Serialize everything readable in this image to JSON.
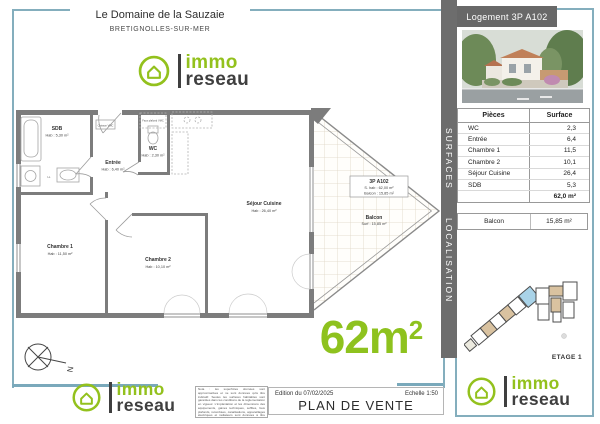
{
  "header": {
    "title": "Le Domaine de la Sauzaie",
    "city": "BRETIGNOLLES-SUR-MER"
  },
  "logo": {
    "line1": "immo",
    "line2": "reseau"
  },
  "right_panel": {
    "header": "Logement 3P A102",
    "sidebar": {
      "surfaces": "SURFACES",
      "localisation": "LOCALISATION"
    }
  },
  "surfaces": {
    "headers": {
      "pieces": "Pièces",
      "surface": "Surface"
    },
    "rows": [
      {
        "label": "WC",
        "value": "2,3"
      },
      {
        "label": "Entrée",
        "value": "6,4"
      },
      {
        "label": "Chambre 1",
        "value": "11,5"
      },
      {
        "label": "Chambre 2",
        "value": "10,1"
      },
      {
        "label": "Séjour Cuisine",
        "value": "26,4"
      },
      {
        "label": "SDB",
        "value": "5,3"
      }
    ],
    "total": "62,0 m²",
    "balcon": {
      "label": "Balcon",
      "value": "15,85 m²"
    }
  },
  "localisation": {
    "etage": "ETAGE 1"
  },
  "plan": {
    "rooms": {
      "sdb": {
        "name": "SDB",
        "area": "Hab : 5,30 m²"
      },
      "entree": {
        "name": "Entrée",
        "area": "Hab : 6,40 m²"
      },
      "wc": {
        "name": "WC",
        "area": "Hab : 2,30 m²"
      },
      "chambre1": {
        "name": "Chambre 1",
        "area": "Hab : 11,50 m²"
      },
      "chambre2": {
        "name": "Chambre 2",
        "area": "Hab : 10,10 m²"
      },
      "sejour": {
        "name": "Séjour Cuisine",
        "area": "Hab : 26,40 m²"
      },
      "balcon": {
        "name": "Balcon",
        "area": "Surf : 15,85 m²"
      }
    },
    "unit_box": {
      "line1": "3P A102",
      "line2": "S. hab : 62,00 m²",
      "line3": "Balcon : 15,85 m²"
    },
    "annotations": {
      "faux_plafond": "Faux plafond VMC",
      "caisson": "Caisson VMC",
      "ll": "LL"
    },
    "compass_n": "N"
  },
  "badge": {
    "value": "62m",
    "sup": "2"
  },
  "footer": {
    "disclaimer": "Nota : les superficies données sont approximatives et ne sont données qu'à titre indicatif. Seules les surfaces habitables sont garanties dans les conditions de la réglementation en vigueur. L'implantation et les dimensions des équipements, gaines techniques, soffites, faux plafonds, retombées, canalisations, appareillages électriques et radiateurs sont données à titre indicatif et sont susceptibles d'être modifiées en cours de réalisation.",
    "edition": "Edition du 07/02/2025",
    "echelle": "Echelle 1:50",
    "title": "PLAN DE VENTE"
  },
  "colors": {
    "accent_green": "#93c11d",
    "frame_teal": "#84aebd",
    "panel_gray": "#6d6d6d",
    "wall_gray": "#7c7c7c"
  }
}
